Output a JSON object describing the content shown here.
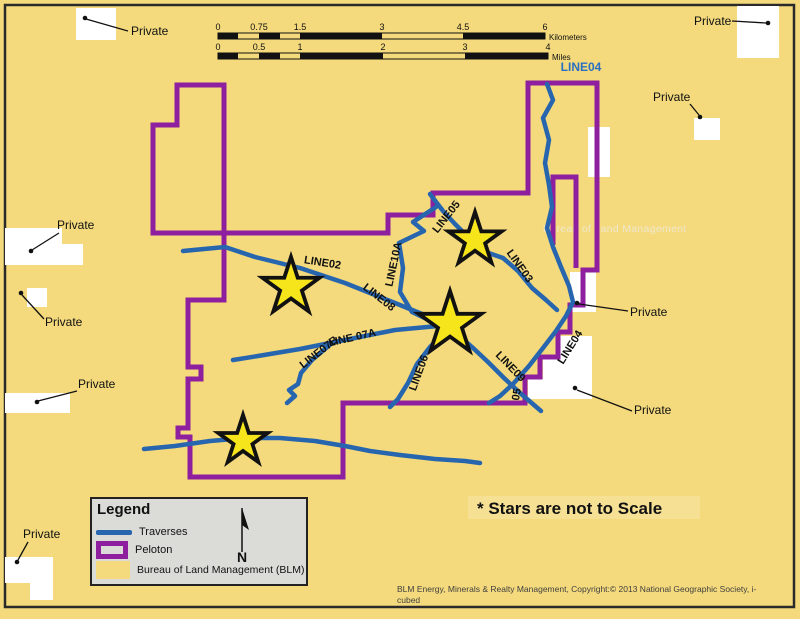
{
  "labels": {
    "private": "Private",
    "watermark": "Bureau of Land Management",
    "note": "* Stars are not to Scale",
    "attribution_line1": "BLM Energy, Minerals & Realty Management, Copyright:© 2013 National Geographic Society, i-",
    "attribution_line2": "cubed",
    "north": "N"
  },
  "scalebar": {
    "km_labels": [
      "0",
      "0.75",
      "1.5",
      "3",
      "4.5",
      "6"
    ],
    "km_unit": "Kilometers",
    "mi_labels": [
      "0",
      "0.5",
      "1",
      "2",
      "3",
      "4"
    ],
    "mi_unit": "Miles"
  },
  "line_labels": [
    {
      "text": "LINE02"
    },
    {
      "text": "LINE08"
    },
    {
      "text": "LINE10A"
    },
    {
      "text": "LINE05"
    },
    {
      "text": "LINE03"
    },
    {
      "text": "LINE04"
    },
    {
      "text": "LINE09"
    },
    {
      "text": "LINE06"
    },
    {
      "text": "05"
    },
    {
      "text": "LINE 07A"
    },
    {
      "text": "LINE07B"
    },
    {
      "text": "LINE04"
    }
  ],
  "legend": {
    "title": "Legend",
    "items": [
      {
        "label": "Traverses"
      },
      {
        "label": "Peloton"
      },
      {
        "label": "Bureau of Land Management (BLM)"
      }
    ]
  },
  "colors": {
    "background_yellow": "#F4DA7D",
    "traverse_blue": "#2766AE",
    "peloton_purple": "#8E1F9E",
    "star_yellow": "#F7E51C",
    "private_white": "#FFFFFF",
    "legend_bg": "#DBDBD8",
    "line04_top_label_blue": "#2B6FC2"
  }
}
